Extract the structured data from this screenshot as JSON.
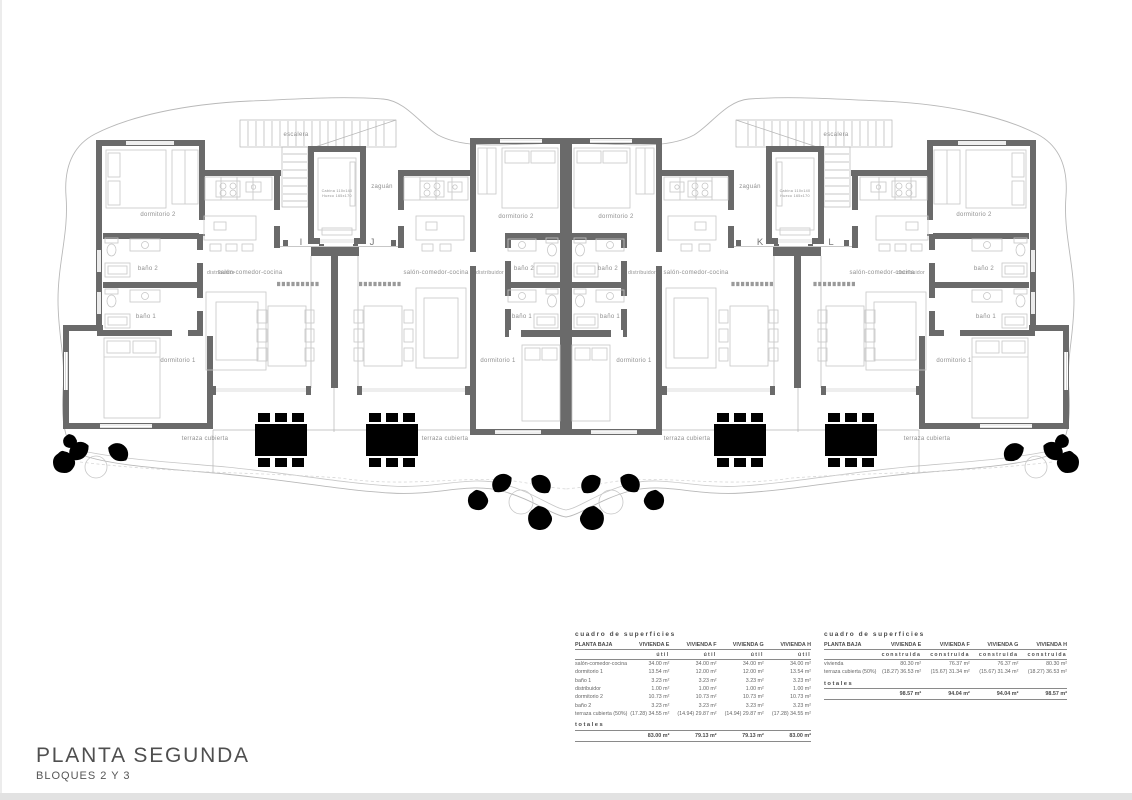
{
  "title_block": {
    "title": "PLANTA SEGUNDA",
    "subtitle": "BLOQUES 2 Y 3"
  },
  "colors": {
    "wall_gray": "#6a6a6a",
    "furniture_gray": "#c7c7c7",
    "label_gray": "#8f8f8f",
    "boundary_gray": "#b8b8b8"
  },
  "plan": {
    "unit_letters": [
      "I",
      "J",
      "K",
      "L"
    ],
    "labels": [
      {
        "text": "escalera",
        "x": 296,
        "y": 136
      },
      {
        "text": "escalera",
        "x": 836,
        "y": 136
      },
      {
        "text": "zaguán",
        "x": 382,
        "y": 188
      },
      {
        "text": "zaguán",
        "x": 750,
        "y": 188
      },
      {
        "text": "Cabina 110x140",
        "x": 337,
        "y": 192,
        "size": 3.7
      },
      {
        "text": "Hueco 165x170",
        "x": 337,
        "y": 197,
        "size": 3.7
      },
      {
        "text": "Cabina 110x140",
        "x": 795,
        "y": 192,
        "size": 3.7
      },
      {
        "text": "Hueco 165x170",
        "x": 795,
        "y": 197,
        "size": 3.7
      },
      {
        "text": "dormitorio 2",
        "x": 158,
        "y": 216
      },
      {
        "text": "dormitorio 2",
        "x": 516,
        "y": 218
      },
      {
        "text": "dormitorio 2",
        "x": 616,
        "y": 218
      },
      {
        "text": "dormitorio 2",
        "x": 974,
        "y": 216
      },
      {
        "text": "baño 2",
        "x": 148,
        "y": 270
      },
      {
        "text": "baño 2",
        "x": 524,
        "y": 270
      },
      {
        "text": "baño 2",
        "x": 608,
        "y": 270
      },
      {
        "text": "baño 2",
        "x": 984,
        "y": 270
      },
      {
        "text": "distribuidor",
        "x": 221,
        "y": 274,
        "size": 5
      },
      {
        "text": "distribuidor",
        "x": 490,
        "y": 274,
        "size": 5
      },
      {
        "text": "distribuidor",
        "x": 642,
        "y": 274,
        "size": 5
      },
      {
        "text": "distribuidor",
        "x": 911,
        "y": 274,
        "size": 5
      },
      {
        "text": "salón-comedor-cocina",
        "x": 250,
        "y": 274
      },
      {
        "text": "salón-comedor-cocina",
        "x": 436,
        "y": 274
      },
      {
        "text": "salón-comedor-cocina",
        "x": 696,
        "y": 274
      },
      {
        "text": "salón-comedor-cocina",
        "x": 882,
        "y": 274
      },
      {
        "text": "baño 1",
        "x": 146,
        "y": 318
      },
      {
        "text": "baño 1",
        "x": 522,
        "y": 318
      },
      {
        "text": "baño 1",
        "x": 610,
        "y": 318
      },
      {
        "text": "baño 1",
        "x": 986,
        "y": 318
      },
      {
        "text": "dormitorio 1",
        "x": 178,
        "y": 362
      },
      {
        "text": "dormitorio 1",
        "x": 498,
        "y": 362
      },
      {
        "text": "dormitorio 1",
        "x": 634,
        "y": 362
      },
      {
        "text": "dormitorio 1",
        "x": 954,
        "y": 362
      },
      {
        "text": "I",
        "x": 301,
        "y": 245,
        "size": 9.5,
        "cls": "unit"
      },
      {
        "text": "J",
        "x": 372,
        "y": 245,
        "size": 9.5,
        "cls": "unit"
      },
      {
        "text": "K",
        "x": 760,
        "y": 245,
        "size": 9.5,
        "cls": "unit"
      },
      {
        "text": "L",
        "x": 831,
        "y": 245,
        "size": 9.5,
        "cls": "unit"
      },
      {
        "text": "terraza cubierta",
        "x": 205,
        "y": 440
      },
      {
        "text": "terraza cubierta",
        "x": 445,
        "y": 440
      },
      {
        "text": "terraza cubierta",
        "x": 687,
        "y": 440
      },
      {
        "text": "terraza cubierta",
        "x": 927,
        "y": 440
      }
    ]
  },
  "tables": [
    {
      "title": "cuadro de superficies",
      "corner": "PLANTA BAJA",
      "columns": [
        "VIVIENDA E",
        "VIVIENDA F",
        "VIVIENDA G",
        "VIVIENDA H"
      ],
      "subheader": "útil",
      "rows": [
        [
          "salón-comedor-cocina",
          "34.00 m²",
          "34.00 m²",
          "34.00 m²",
          "34.00 m²"
        ],
        [
          "dormitorio 1",
          "13.54 m²",
          "12.00 m²",
          "12.00 m²",
          "13.54 m²"
        ],
        [
          "baño 1",
          "3.23 m²",
          "3.23 m²",
          "3.23 m²",
          "3.23 m²"
        ],
        [
          "distribuidor",
          "1.00 m²",
          "1.00 m²",
          "1.00 m²",
          "1.00 m²"
        ],
        [
          "dormitorio 2",
          "10.73 m²",
          "10.73 m²",
          "10.73 m²",
          "10.73 m²"
        ],
        [
          "baño 2",
          "3.23 m²",
          "3.23 m²",
          "3.23 m²",
          "3.23 m²"
        ],
        [
          "terraza cubierta (50%)",
          "(17.28) 34.55 m²",
          "(14.94) 29.87 m²",
          "(14.94) 29.87 m²",
          "(17.28) 34.55 m²"
        ]
      ],
      "totals_label": "totales",
      "totals": [
        "83.00 m²",
        "79.13 m²",
        "79.13 m²",
        "83.00 m²"
      ]
    },
    {
      "title": "cuadro de superficies",
      "corner": "PLANTA BAJA",
      "columns": [
        "VIVIENDA E",
        "VIVIENDA F",
        "VIVIENDA G",
        "VIVIENDA H"
      ],
      "subheader": "construida",
      "rows": [
        [
          "vivienda",
          "80.30 m²",
          "76.37 m²",
          "76.37 m²",
          "80.30 m²"
        ],
        [
          "terraza cubierta (50%)",
          "(18.27) 36.53 m²",
          "(15.67) 31.34 m²",
          "(15.67) 31.34 m²",
          "(18.27) 36.53 m²"
        ]
      ],
      "totals_label": "totales",
      "totals": [
        "98.57 m²",
        "94.04 m²",
        "94.04 m²",
        "98.57 m²"
      ]
    }
  ]
}
